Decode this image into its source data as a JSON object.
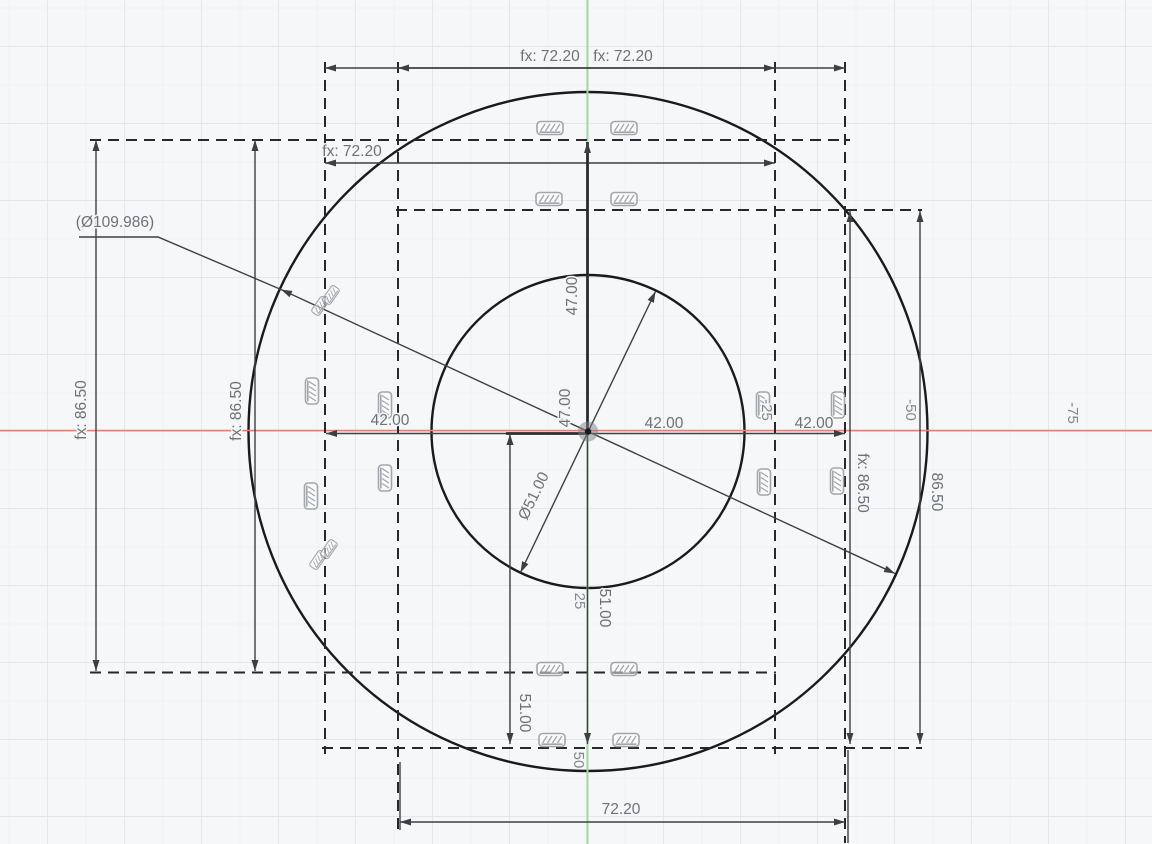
{
  "app": {
    "view": "cad-sketch-canvas"
  },
  "colors": {
    "axis_x": "#e4807a",
    "axis_y": "#a7d7a7",
    "profile_fill": "#e2ecf7",
    "inner_fill": "#e9f1f9",
    "sketch_line": "#1a1a1c",
    "dim_text": "#6d7277",
    "constraint_icon": "#9aa0a6"
  },
  "icons": {
    "fixed_constraint": "hatched-bar-glyph"
  },
  "dimensions": {
    "top_width_a": "fx: 72.20",
    "top_width_b": "fx: 72.20",
    "upper_width": "fx: 72.20",
    "left_height_outer": "fx: 86.50",
    "left_height_inner": "fx: 86.50",
    "right_height_inner": "fx: 86.50",
    "right_height_outer": "86.50",
    "outer_diameter_ref": "(Ø109.986)",
    "inner_diameter": "Ø51.00",
    "center_height_upper": "47.00",
    "center_height_lower_label": "47.00",
    "half_width_left": "42.00",
    "half_width_right": "42.00",
    "half_width_right_outer": "42.00",
    "lower_height_right": "51.00",
    "lower_height_left": "51.00",
    "bottom_width": "72.20"
  },
  "grid_ruler": {
    "x_neg_25": "-25",
    "x_neg_50": "-50",
    "x_neg_75": "-75",
    "y_25": "25",
    "y_50": "50"
  }
}
